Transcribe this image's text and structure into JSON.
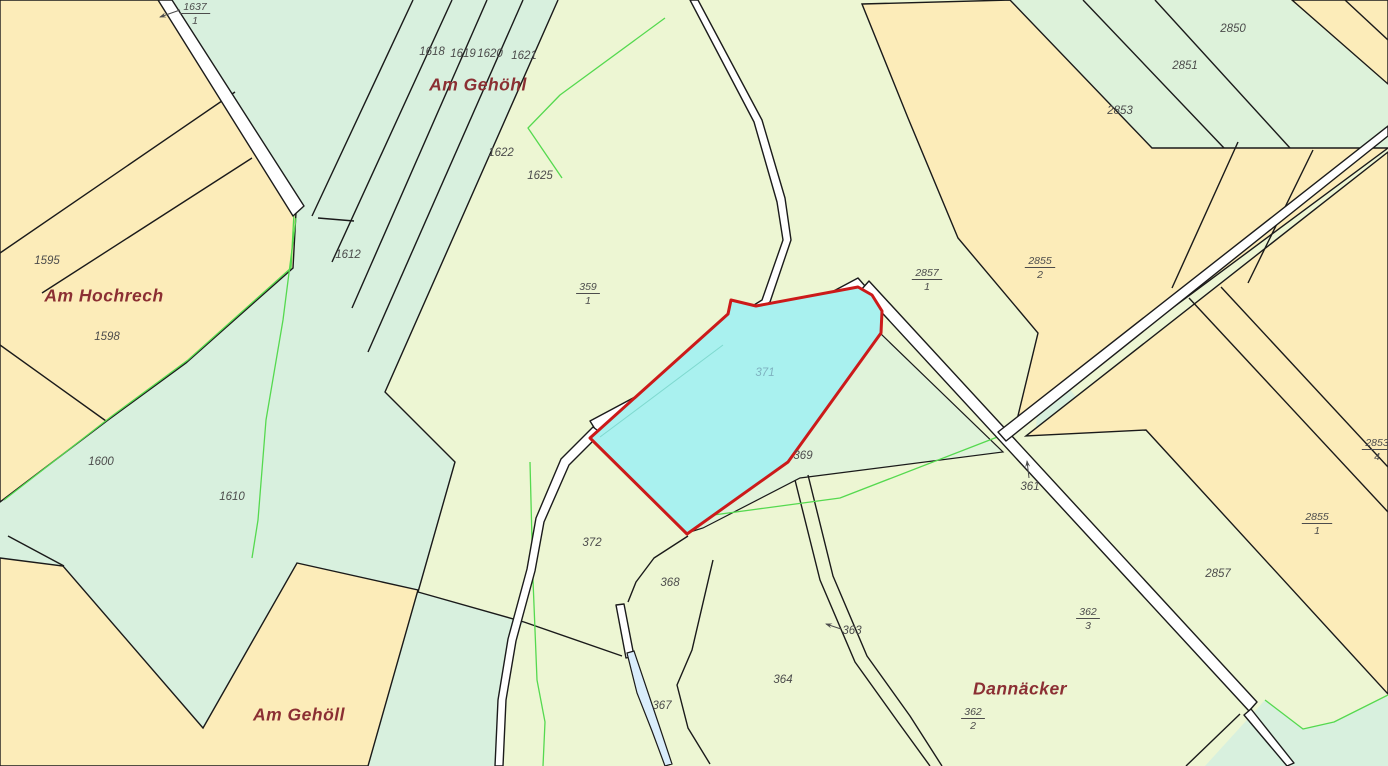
{
  "map": {
    "title": "cadastral-parcel-map",
    "highlighted_parcel": {
      "label": "371",
      "fill": "#a9f1ef",
      "stroke": "#cc1a1a"
    },
    "colors": {
      "background_pale": "#edf6d3",
      "mint": "#d8f0de",
      "mint_strips": "#ddf2da",
      "yellow": "#fcecb9",
      "boundary": "#1a1a1a",
      "vegetation_line": "#55d94f",
      "stream": "#d9edfb",
      "road": "#ffffff",
      "parcel_label": "#4c4c4c",
      "place_label": "#8b2f33",
      "highlight_label": "#7fb2c0"
    },
    "place_names": [
      {
        "text": "Am Gehöhl",
        "x": 478,
        "y": 86
      },
      {
        "text": "Am Hochrech",
        "x": 104,
        "y": 297
      },
      {
        "text": "Am Gehöll",
        "x": 299,
        "y": 716
      },
      {
        "text": "Dannäcker",
        "x": 1020,
        "y": 690
      }
    ],
    "parcel_labels": [
      {
        "type": "fraction",
        "num": "1637",
        "den": "1",
        "x": 195,
        "y": 2,
        "arrow": {
          "x1": 180,
          "y1": 10,
          "x2": 160,
          "y2": 17
        }
      },
      {
        "type": "plain",
        "text": "1618",
        "x": 432,
        "y": 52
      },
      {
        "type": "plain",
        "text": "1619",
        "x": 463,
        "y": 54
      },
      {
        "type": "plain",
        "text": "1620",
        "x": 490,
        "y": 54
      },
      {
        "type": "plain",
        "text": "1621",
        "x": 524,
        "y": 56
      },
      {
        "type": "plain",
        "text": "1622",
        "x": 501,
        "y": 153
      },
      {
        "type": "plain",
        "text": "1625",
        "x": 540,
        "y": 176
      },
      {
        "type": "plain",
        "text": "1612",
        "x": 348,
        "y": 255
      },
      {
        "type": "plain",
        "text": "1595",
        "x": 47,
        "y": 261
      },
      {
        "type": "plain",
        "text": "1598",
        "x": 107,
        "y": 337
      },
      {
        "type": "plain",
        "text": "1600",
        "x": 101,
        "y": 462
      },
      {
        "type": "plain",
        "text": "1610",
        "x": 232,
        "y": 497
      },
      {
        "type": "fraction",
        "num": "359",
        "den": "1",
        "x": 588,
        "y": 282
      },
      {
        "type": "plain",
        "text": "371",
        "x": 765,
        "y": 373,
        "color": "#7fb2c0"
      },
      {
        "type": "plain",
        "text": "369",
        "x": 803,
        "y": 456
      },
      {
        "type": "plain",
        "text": "372",
        "x": 592,
        "y": 543
      },
      {
        "type": "plain",
        "text": "368",
        "x": 670,
        "y": 583
      },
      {
        "type": "plain",
        "text": "367",
        "x": 662,
        "y": 706
      },
      {
        "type": "plain",
        "text": "364",
        "x": 783,
        "y": 680
      },
      {
        "type": "plain",
        "text": "363",
        "x": 852,
        "y": 631,
        "arrow": {
          "x1": 841,
          "y1": 629,
          "x2": 826,
          "y2": 624
        }
      },
      {
        "type": "plain",
        "text": "361",
        "x": 1030,
        "y": 487,
        "arrow": {
          "x1": 1029,
          "y1": 478,
          "x2": 1027,
          "y2": 461
        }
      },
      {
        "type": "plain",
        "text": "2850",
        "x": 1233,
        "y": 29
      },
      {
        "type": "plain",
        "text": "2851",
        "x": 1185,
        "y": 66
      },
      {
        "type": "plain",
        "text": "2853",
        "x": 1120,
        "y": 111
      },
      {
        "type": "fraction",
        "num": "2857",
        "den": "1",
        "x": 927,
        "y": 268
      },
      {
        "type": "fraction",
        "num": "2855",
        "den": "2",
        "x": 1040,
        "y": 256
      },
      {
        "type": "fraction",
        "num": "2853",
        "den": "4",
        "x": 1377,
        "y": 438
      },
      {
        "type": "fraction",
        "num": "2855",
        "den": "1",
        "x": 1317,
        "y": 512
      },
      {
        "type": "plain",
        "text": "2857",
        "x": 1218,
        "y": 574
      },
      {
        "type": "fraction",
        "num": "362",
        "den": "3",
        "x": 1088,
        "y": 607
      },
      {
        "type": "fraction",
        "num": "362",
        "den": "2",
        "x": 973,
        "y": 707
      }
    ]
  }
}
